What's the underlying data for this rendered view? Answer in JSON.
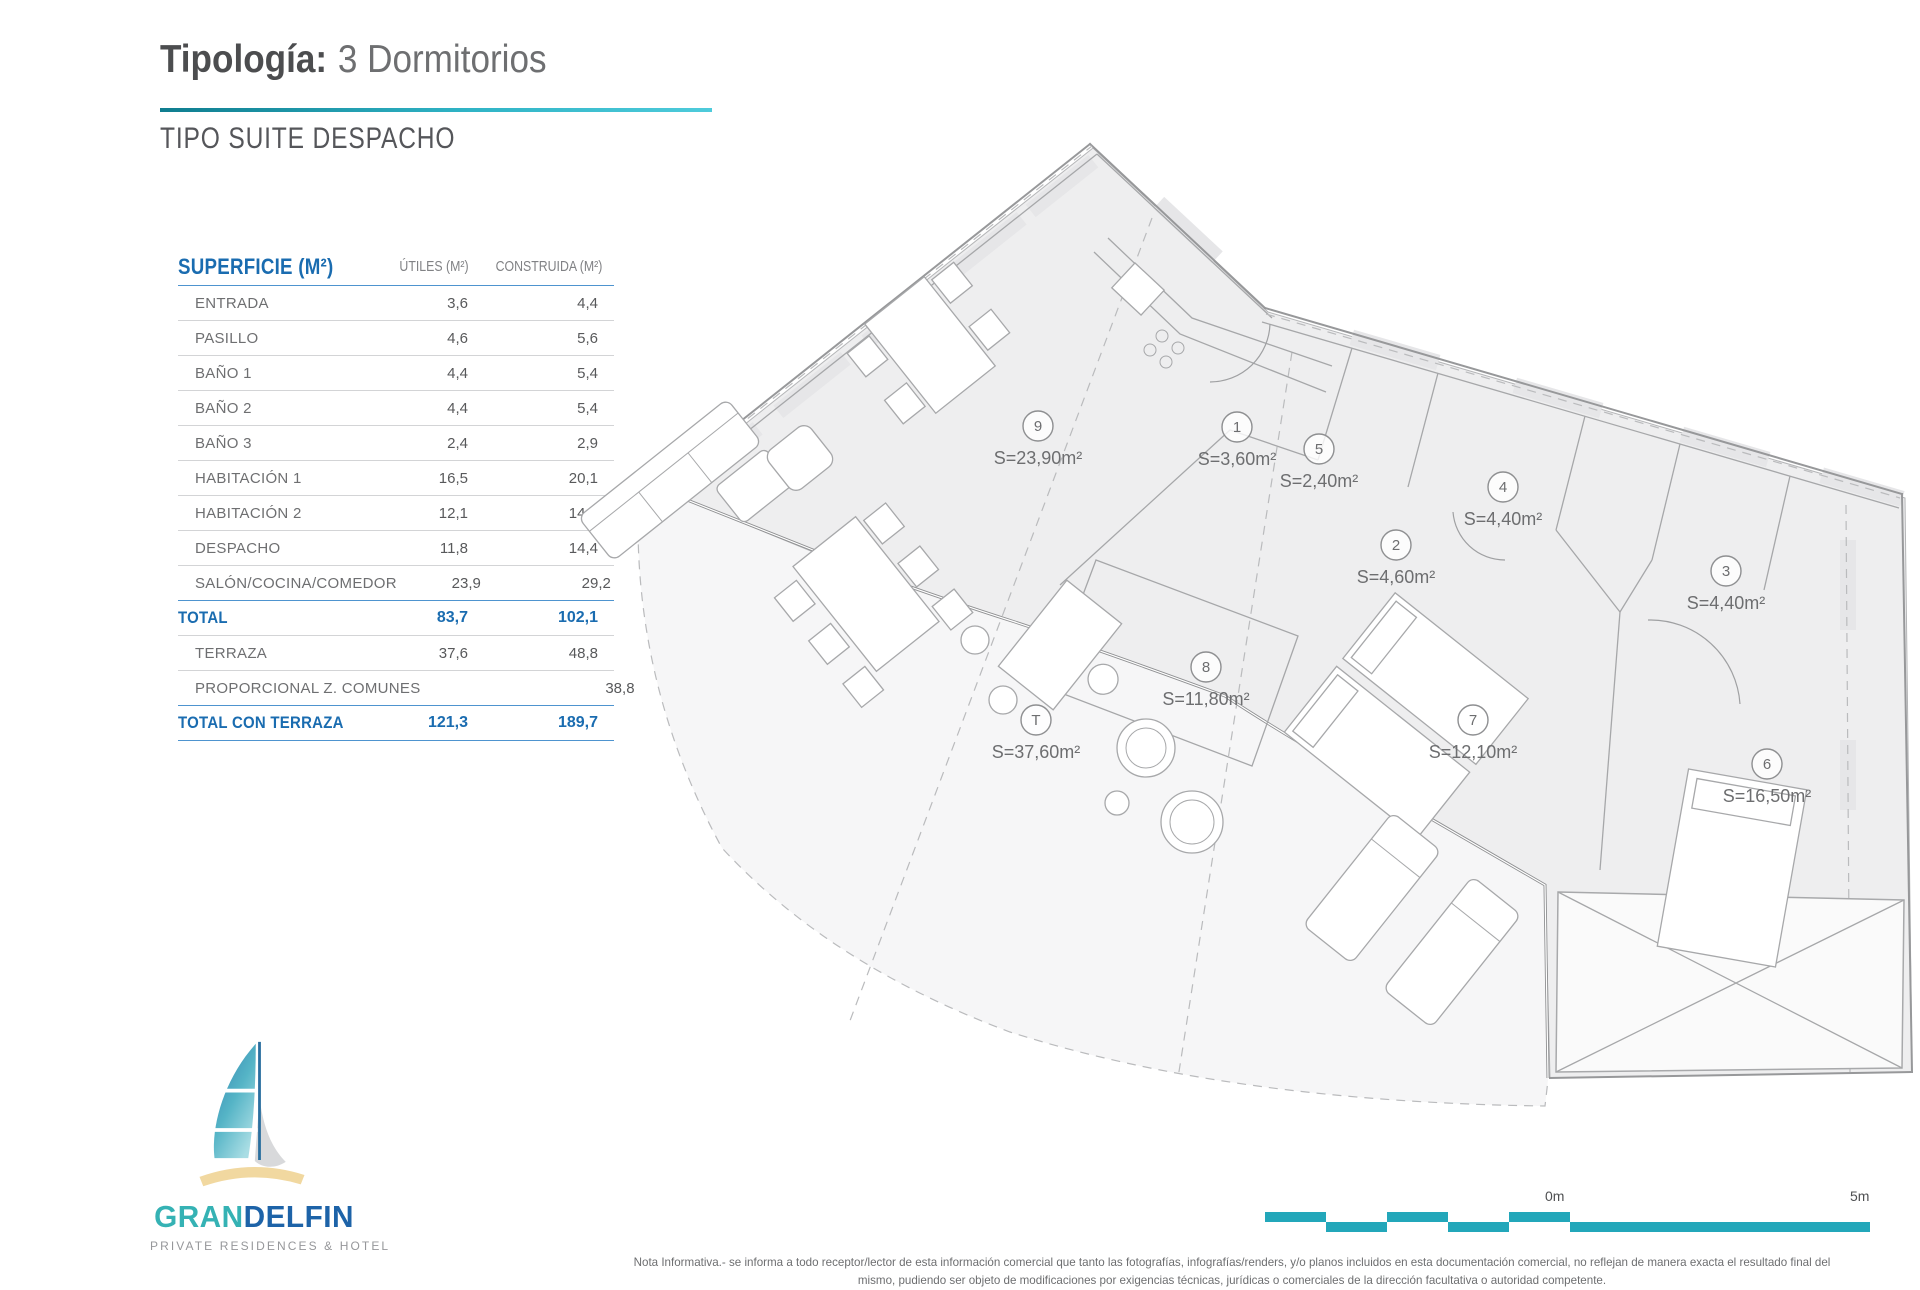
{
  "header": {
    "title_bold": "Tipología:",
    "title_rest": "3 Dormitorios",
    "subtitle": "TIPO SUITE DESPACHO"
  },
  "table": {
    "title": "SUPERFICIE (M²)",
    "col_utiles": "ÚTILES (M²)",
    "col_construida": "CONSTRUIDA (M²)",
    "rows": [
      {
        "label": "ENTRADA",
        "utiles": "3,6",
        "construida": "4,4"
      },
      {
        "label": "PASILLO",
        "utiles": "4,6",
        "construida": "5,6"
      },
      {
        "label": "BAÑO 1",
        "utiles": "4,4",
        "construida": "5,4"
      },
      {
        "label": "BAÑO 2",
        "utiles": "4,4",
        "construida": "5,4"
      },
      {
        "label": "BAÑO 3",
        "utiles": "2,4",
        "construida": "2,9"
      },
      {
        "label": "HABITACIÓN 1",
        "utiles": "16,5",
        "construida": "20,1"
      },
      {
        "label": "HABITACIÓN 2",
        "utiles": "12,1",
        "construida": "14,8"
      },
      {
        "label": "DESPACHO",
        "utiles": "11,8",
        "construida": "14,4"
      },
      {
        "label": "SALÓN/COCINA/COMEDOR",
        "utiles": "23,9",
        "construida": "29,2"
      }
    ],
    "total": {
      "label": "TOTAL",
      "utiles": "83,7",
      "construida": "102,1"
    },
    "extra_rows": [
      {
        "label": "TERRAZA",
        "utiles": "37,6",
        "construida": "48,8"
      },
      {
        "label": "PROPORCIONAL Z. COMUNES",
        "utiles": "",
        "construida": "38,8"
      }
    ],
    "total_terraza": {
      "label": "TOTAL CON TERRAZA",
      "utiles": "121,3",
      "construida": "189,7"
    }
  },
  "plan": {
    "labels": [
      {
        "num": "9",
        "area": "S=23,90m²",
        "x": 1038,
        "y": 426
      },
      {
        "num": "1",
        "area": "S=3,60m²",
        "x": 1237,
        "y": 427
      },
      {
        "num": "5",
        "area": "S=2,40m²",
        "x": 1319,
        "y": 449
      },
      {
        "num": "4",
        "area": "S=4,40m²",
        "x": 1503,
        "y": 487
      },
      {
        "num": "2",
        "area": "S=4,60m²",
        "x": 1396,
        "y": 545
      },
      {
        "num": "3",
        "area": "S=4,40m²",
        "x": 1726,
        "y": 571
      },
      {
        "num": "8",
        "area": "S=11,80m²",
        "x": 1206,
        "y": 667
      },
      {
        "num": "T",
        "area": "S=37,60m²",
        "x": 1036,
        "y": 720
      },
      {
        "num": "7",
        "area": "S=12,10m²",
        "x": 1473,
        "y": 720
      },
      {
        "num": "6",
        "area": "S=16,50m²",
        "x": 1767,
        "y": 764
      }
    ]
  },
  "scalebar": {
    "zero": "0m",
    "five": "5m"
  },
  "logo": {
    "gran": "GRAN",
    "delfin": "DELFIN",
    "caption": "PRIVATE RESIDENCES & HOTEL"
  },
  "footer": {
    "line1": "Nota Informativa.- se informa a todo receptor/lector de esta información comercial que tanto las fotografías, infografías/renders, y/o planos incluidos en esta documentación comercial, no reflejan de manera exacta el resultado final del",
    "line2": "mismo, pudiendo ser objeto de modificaciones por exigencias técnicas, jurídicas o comerciales de la dirección facultativa o autoridad competente."
  },
  "colors": {
    "accent_teal": "#23a7ba",
    "table_blue": "#1a6cb0"
  }
}
